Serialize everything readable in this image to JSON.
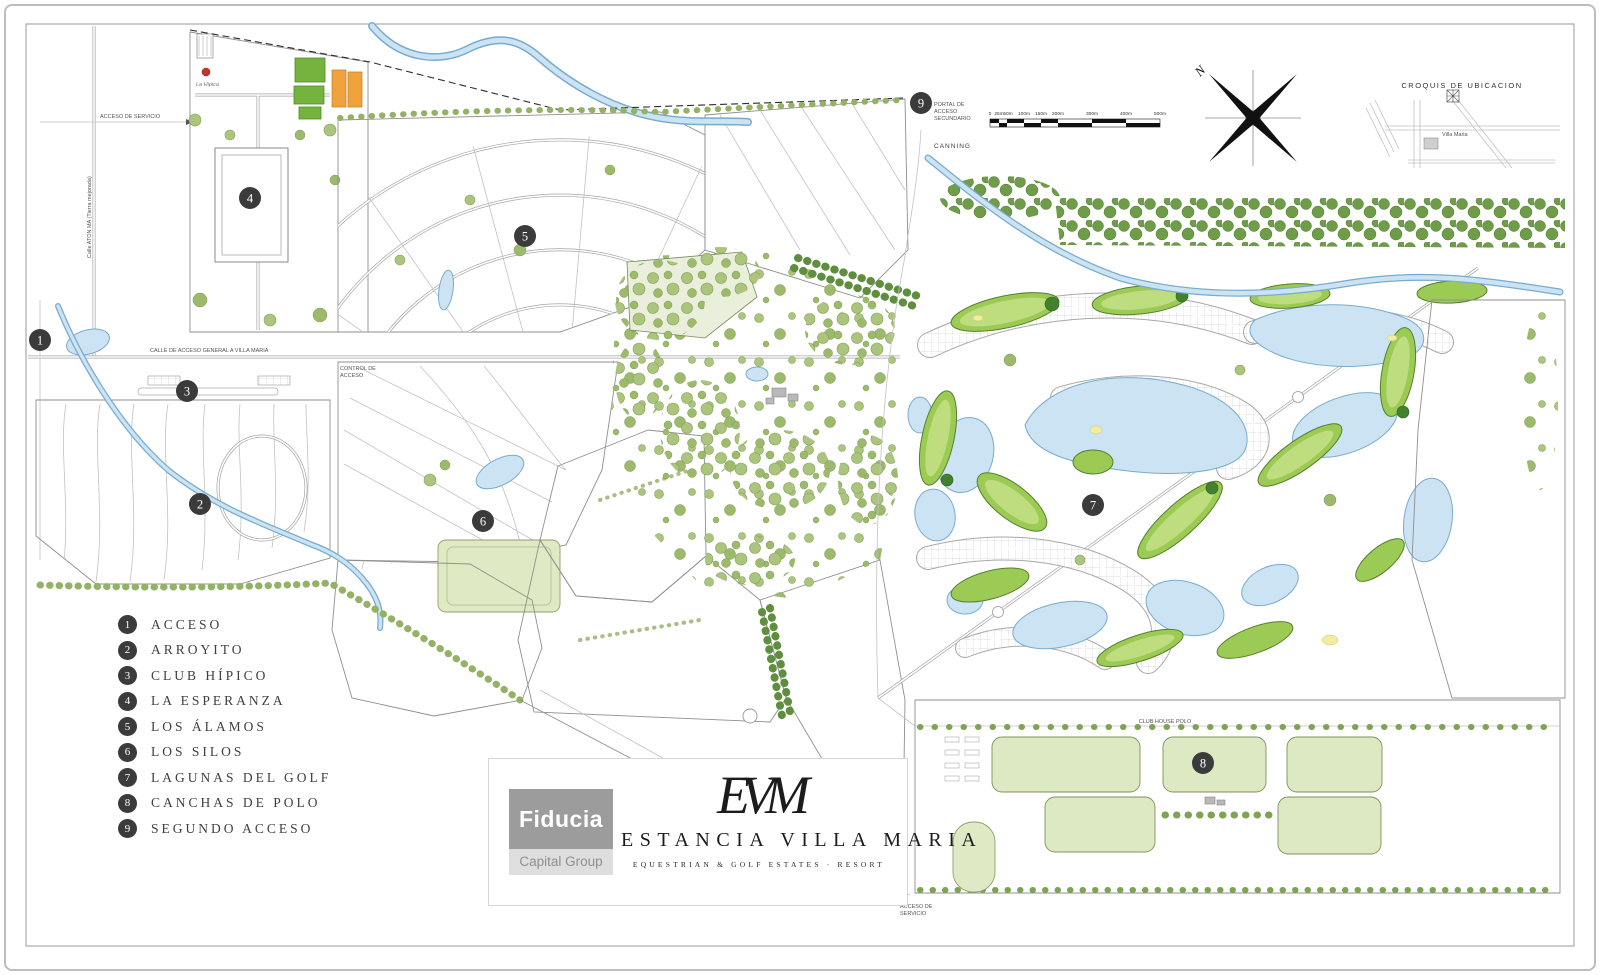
{
  "legend": {
    "items": [
      {
        "num": "1",
        "label": "ACCESO"
      },
      {
        "num": "2",
        "label": "ARROYITO"
      },
      {
        "num": "3",
        "label": "CLUB HÍPICO"
      },
      {
        "num": "4",
        "label": "LA ESPERANZA"
      },
      {
        "num": "5",
        "label": "LOS ÁLAMOS"
      },
      {
        "num": "6",
        "label": "LOS SILOS"
      },
      {
        "num": "7",
        "label": "LAGUNAS DEL GOLF"
      },
      {
        "num": "8",
        "label": "CANCHAS DE POLO"
      },
      {
        "num": "9",
        "label": "SEGUNDO ACCESO"
      }
    ]
  },
  "brand": {
    "fiducia": "Fiducia",
    "capital_group": "Capital Group",
    "monogram": "EVM",
    "title": "ESTANCIA VILLA MARIA",
    "subtitle": "EQUESTRIAN   &   GOLF  ESTATES   ·   RESORT"
  },
  "annotations": {
    "croquis_title": "CROQUIS  DE  UBICACION",
    "croquis_site": "Villa Maria",
    "north": "N",
    "portal_line1": "PORTAL DE",
    "portal_line2": "ACCESO",
    "portal_line3": "SECUNDARIO",
    "canning": "CANNING",
    "service_bottom_line1": "ACCESO DE",
    "service_bottom_line2": "SERVICIO",
    "service_left": "ACCESO DE SERVICIO",
    "main_access_road": "CALLE DE ACCESO GENERAL A VILLA MARIA",
    "access_control_line1": "CONTROL DE",
    "access_control_line2": "ACCESO",
    "left_road": "Calle ATON MA  (Tierra mejorada)",
    "polo_road": "CLUB HOUSE POLO",
    "la_hipica": "La Hipica"
  },
  "scale_bar": {
    "labels": [
      "0",
      "25m",
      "50m",
      "100m",
      "150m",
      "200m",
      "300m",
      "400m",
      "500m"
    ]
  },
  "colors": {
    "marker": "#3b3b3b",
    "water": "#cbe3f3",
    "fairway": "#9ccb55",
    "field": "#e8eeda",
    "tree": "#abc57e",
    "buildings_orange": "#f0a23c",
    "fiducia_gray": "#9c9c9c"
  }
}
